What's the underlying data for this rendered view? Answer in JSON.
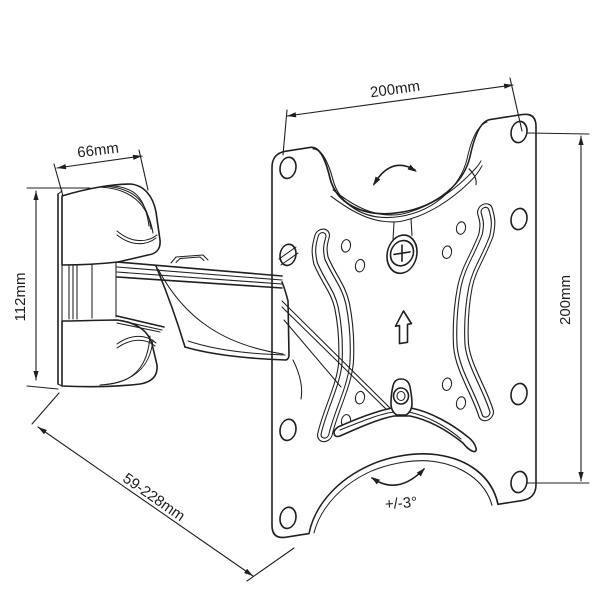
{
  "drawing": {
    "type": "technical-line-drawing",
    "subject": "Articulating TV wall mount with VESA plate",
    "dimensions": {
      "plate_width": "200mm",
      "plate_height": "200mm",
      "wall_bracket_width": "66mm",
      "wall_bracket_height": "112mm",
      "extension_range": "59-228mm",
      "tilt_range": "+/-3°"
    },
    "colors": {
      "line": "#1f1f1f",
      "background": "#ffffff"
    }
  }
}
